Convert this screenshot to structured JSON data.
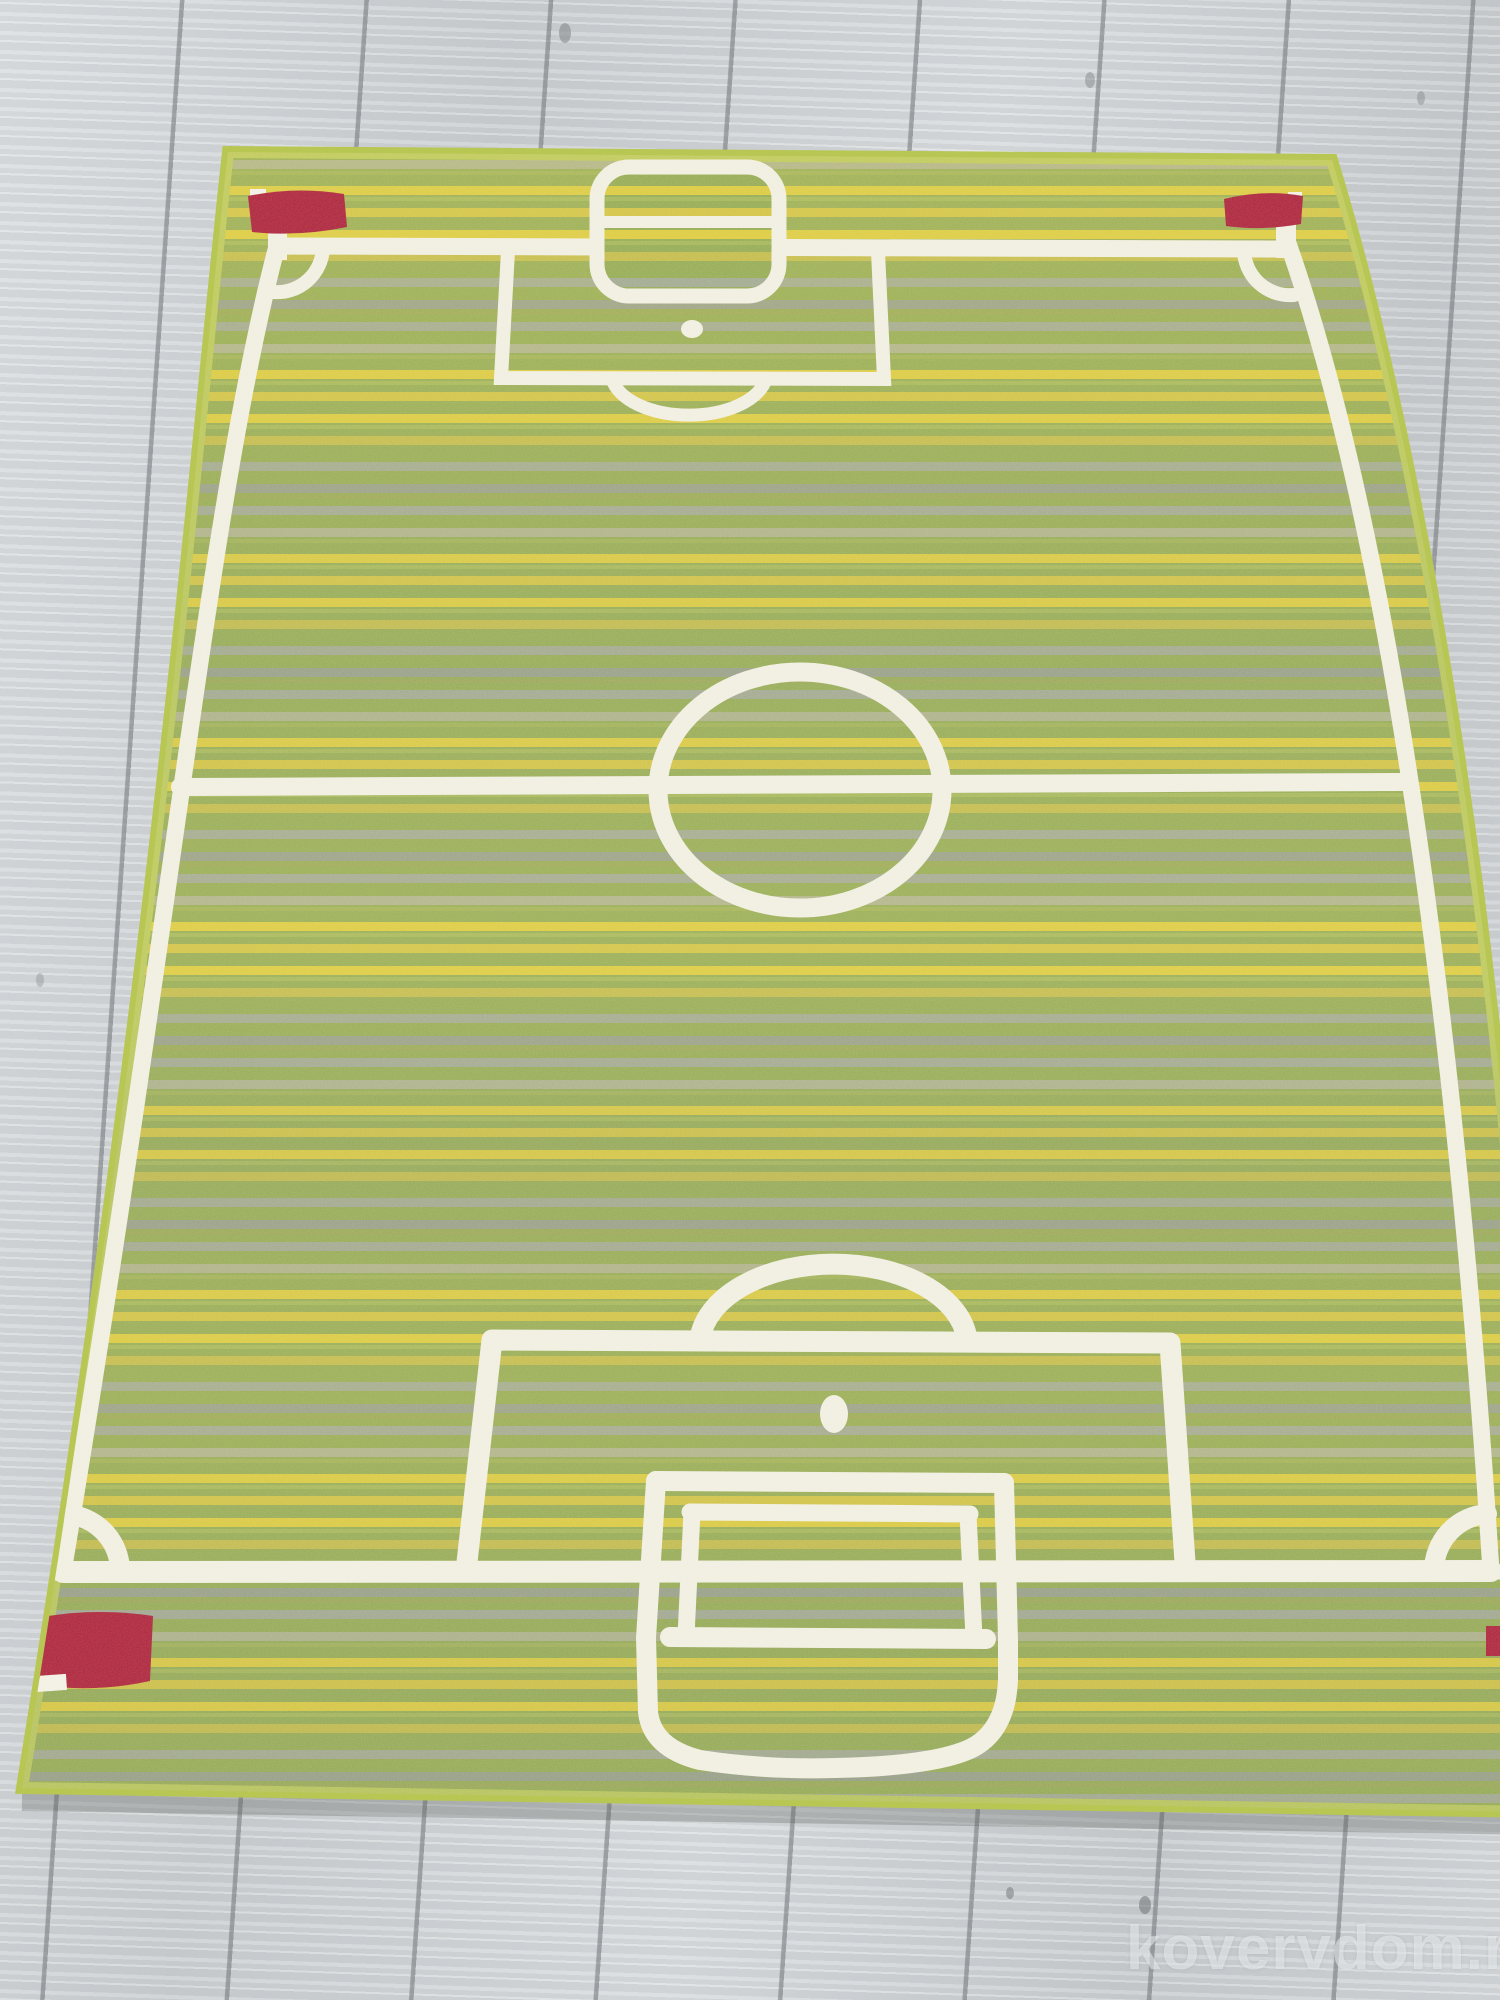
{
  "image": {
    "type": "product photograph",
    "subject": "Children's green rug printed as a striped soccer field, photographed in perspective on a light gray laminate wood floor"
  },
  "watermark": {
    "text": "kovervdom.ru"
  },
  "rug": {
    "description": "Football pitch kids carpet with horizontal pile stripes",
    "base_color": "#8CA444",
    "stripe_yellow": "#D9C62E",
    "stripe_gray": "#99A187",
    "binding_color": "#B5C44C",
    "line_color": "#EFEDDE",
    "flag_color": "#A6102A",
    "markings": [
      "outer boundary line",
      "halfway line",
      "center circle",
      "far penalty area with spot, arc and goal with crossbar",
      "near penalty area with spot, arc and goal with crossbar",
      "corner arcs",
      "red corner flags (top-left, top-right, bottom-left, bottom-right clipped)"
    ]
  },
  "floor": {
    "material": "gray oak laminate planks",
    "color": "#CDD1D4",
    "seam_color": "#9FA3A6"
  }
}
